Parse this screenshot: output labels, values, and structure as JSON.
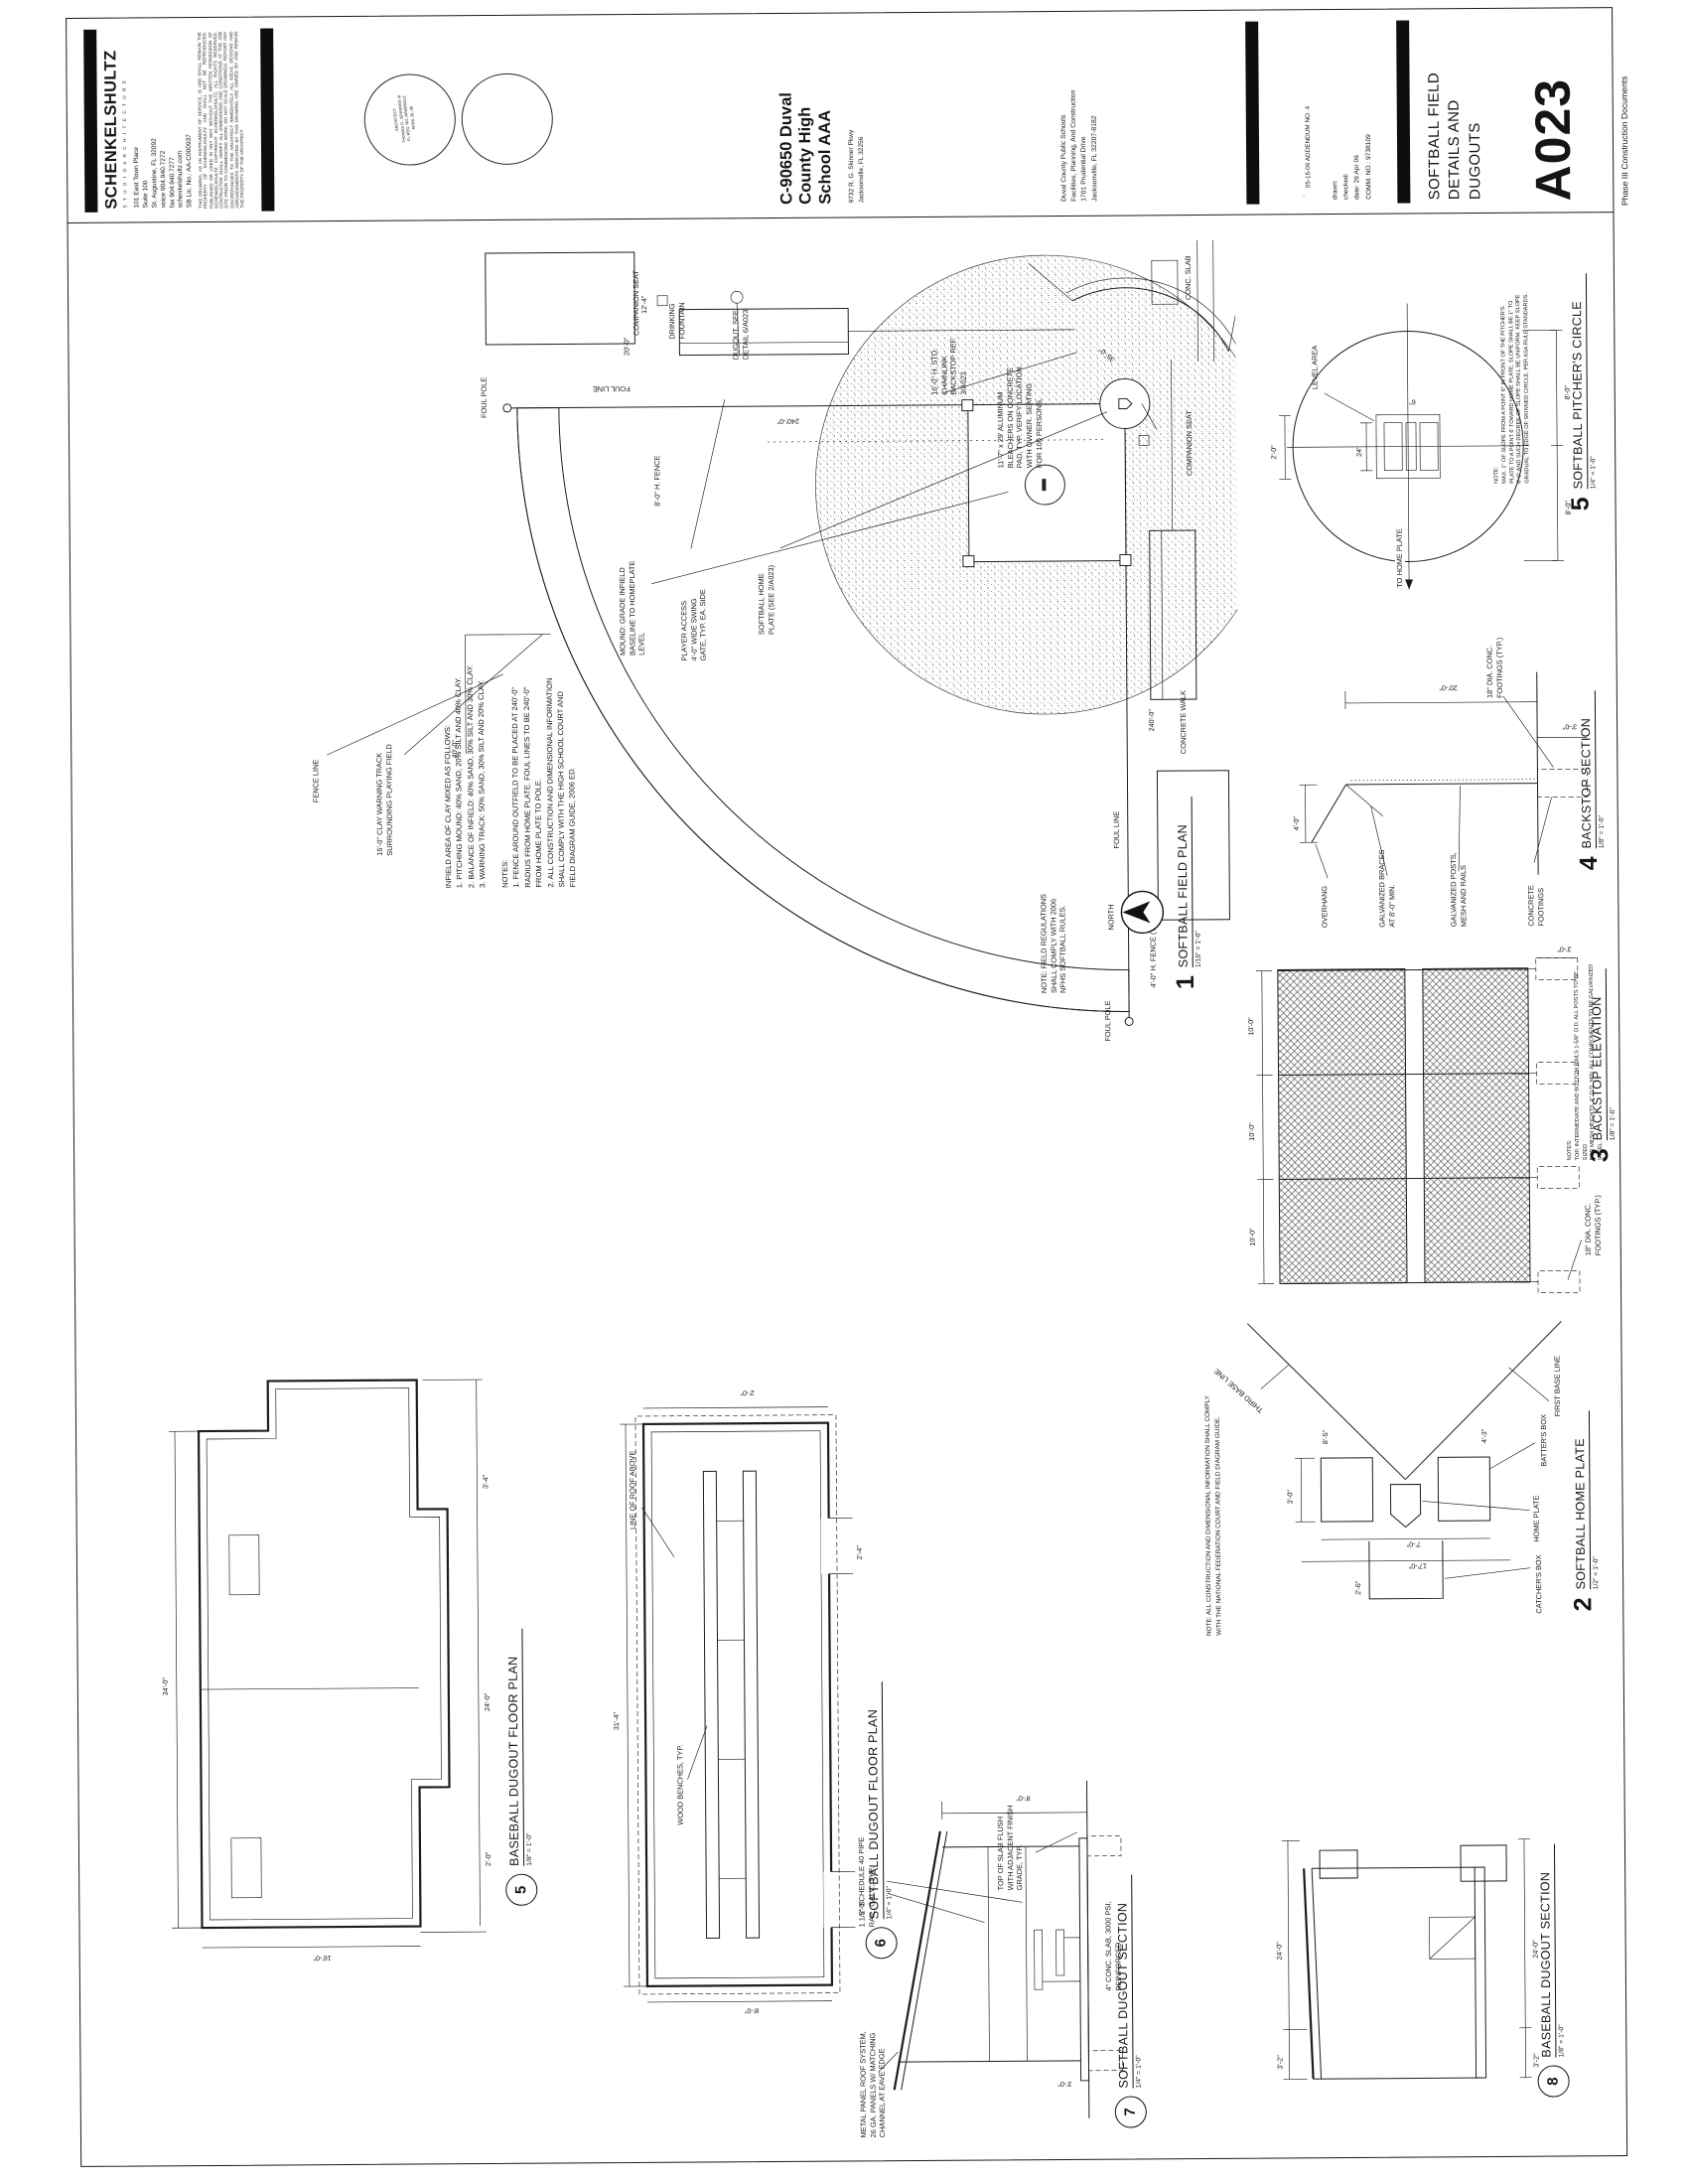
{
  "firm": {
    "name": "SCHENKELSHULTZ",
    "tagline": "S T U D I O   A R C H I T E C T U R E",
    "lines": "101 East Town Place\nSuite 100\nSt. Augustine, FL 32092\nvoice  904.940.7272\nfax  904.940.7277\nschenkelshultz.com\nSB Lic. No.: AA-C000937",
    "disclaimer": "THIS DRAWING, AS AN INSTRUMENT OF SERVICE, IS AND SHALL REMAIN THE PROPERTY OF SCHENKELSHULTZ AND SHALL NOT BE REPRODUCED, PUBLISHED OR USED IN ANY WAY WITHOUT THE WRITTEN PERMISSION OF SCHENKELSHULTZ. COPYRIGHT SCHENKELSHULTZ. ALL RIGHTS RESERVED. CONTRACTOR SHALL VERIFY ALL DIMENSIONS AND CONDITIONS AT THE JOB SITE PRIOR TO COMMENCING WORK. DO NOT SCALE DRAWINGS. REPORT ANY DISCREPANCIES TO THE ARCHITECT IMMEDIATELY. ALL IDEAS, DESIGNS AND ARRANGEMENTS INDICATED BY THIS DRAWING ARE OWNED BY AND REMAIN THE PROPERTY OF THE ARCHITECT."
  },
  "seal": {
    "text": "ARCHITECT\nTHOMAS G. JENNINGS III\nFL REG. NO. AR0009413\nAPRIL 26, 06"
  },
  "project": {
    "name": "C-90650 Duval\nCounty High\nSchool AAA",
    "addr": "9732 R. G. Skinner Pkwy\nJacksonville, FL 32256"
  },
  "owner": {
    "lines": "Duval County Public Schools\nFacilities, Planning, And Construction\n1701 Prudential Drive\nJacksonville, FL 32207-8182"
  },
  "revision": {
    "entry": "05-15-06   ADDENDUM NO. 4"
  },
  "credits": {
    "lines": "drawn:\nchecked:\ndate:   26 Apr 06\nCOMM. NO.:   9738109"
  },
  "sheet": {
    "title": "SOFTBALL FIELD\nDETAILS AND\nDUGOUTS",
    "number": "A023",
    "phase": "Phase III Construction Documents"
  },
  "plan": {
    "num": "1",
    "title": "SOFTBALL FIELD PLAN",
    "scale": "1/16\" = 1'-0\"",
    "north_label": "NORTH",
    "labels": {
      "foul_pole_top": "FOUL POLE",
      "foul_pole_left": "FOUL POLE",
      "fence_line": "FENCE LINE",
      "foul_line_v": "FOUL LINE",
      "foul_line_h": "FOUL LINE",
      "warning_track": "15'-0\" CLAY WARNING TRACK\nSURROUNDING PLAYING FIELD",
      "home_plate": "SOFTBALL HOME\nPLATE (SEE 2/A023)",
      "mound": "MOUND: GRADE INFIELD\nBASELINE TO HOMEPLATE\nLEVEL",
      "backstop": "16'-0\" H. STD.\nCHAINLINK\nBACKSTOP REF.\n3/A023",
      "bleachers": "11'-7\" x 29' ALUMINUM\nBLEACHERS ON CONCRETE\nPAD, TYP. VERIFY LOCATION\nWITH OWNER. SEATING\nFOR 100 PERSONS.",
      "dugout": "DUGOUT, SEE\nDETAIL 6/A023",
      "fountain": "DRINKING\nFOUNTAIN",
      "companion1": "COMPANION SEAT",
      "companion2": "COMPANION SEAT",
      "gate": "PLAYER ACCESS\n4'-0\" WIDE SWING\nGATE, TYP. EA. SIDE",
      "fence4": "4'-0\" H. FENCE (TYP.)",
      "fence8": "8'-0\" H. FENCE",
      "slab": "CONC. SLAB",
      "walk": "CONCRETE WALK",
      "note": "NOTE: FIELD REGULATIONS\nSHALL COMPLY WITH 2006\nNFHS SOFTBALL RULES."
    },
    "dims": {
      "r1": "240'-0\"",
      "r2": "240'-0\"",
      "d40": "40'-0\"",
      "d35": "35'-0\"",
      "d20": "20'-0\"",
      "d12": "12'-4\""
    },
    "notes_block": "INFIELD AREA OF CLAY MIXED AS FOLLOWS:\n1. PITCHING MOUND: 40% SAND, 20% SILT AND 40% CLAY.\n2. BALANCE OF INFIELD: 40% SAND, 30% SILT AND 30% CLAY.\n3. WARNING TRACK: 50% SAND, 30% SILT AND 20% CLAY.\n \nNOTES:\n1. FENCE AROUND OUTFIELD TO BE PLACED AT 240'-0\"\n    RADIUS FROM HOME PLATE. FOUL LINES TO BE 240'-0\"\n    FROM HOME PLATE TO POLE.\n2. ALL CONSTRUCTION AND DIMENSIONAL INFORMATION\n    SHALL COMPLY WITH THE HIGH SCHOOL COURT AND\n    FIELD DIAGRAM GUIDE, 2006 ED."
  },
  "hp": {
    "num": "2",
    "title": "SOFTBALL HOME PLATE",
    "scale": "1/2\" = 1'-0\"",
    "note": "NOTE:  ALL CONSTRUCTION AND DIMENSIONAL INFORMATION SHALL COMPLY\nWITH THE NATIONAL FEDERATION COURT AND FIELD DIAGRAM GUIDE.",
    "labels": {
      "third": "THIRD BASE LINE",
      "first": "FIRST BASE LINE",
      "home": "HOME PLATE",
      "batter": "BATTER'S BOX",
      "catcher": "CATCHER'S BOX"
    },
    "dims": {
      "d1": "3'-0\"",
      "d2": "7'-0\"",
      "d3": "17'-0\"",
      "d4": "8'-5\"",
      "d5": "2'-6\"",
      "d6": "4'-3\""
    }
  },
  "el": {
    "num": "3",
    "title": "BACKSTOP ELEVATION",
    "scale": "1/8\" = 1'-0\"",
    "notes": "NOTES:\nTOP, INTERMEDIATE AND BOTTOM RAILS 1-5/8\" O.D. ALL POSTS TO BE SIZED\nFOR MESH HEIGHTS, 4\" O.D. MIN. ALL COMPONENTS TO BE GALVANIZED STEEL.",
    "footing_label": "18\" DIA. CONC.\nFOOTINGS (TYP.)",
    "dims": {
      "a": "10'-0\"",
      "b": "10'-0\"",
      "c": "10'-0\"",
      "depth": "3'-0\""
    }
  },
  "sec": {
    "num": "4",
    "title": "BACKSTOP SECTION",
    "scale": "1/8\" = 1'-0\"",
    "labels": {
      "overhang": "OVERHANG",
      "braces": "GALVANIZED BRACES\nAT 8'-0\" MIN.",
      "posts": "GALVANIZED POSTS,\nMESH AND RAILS",
      "footings": "CONCRETE FOOTINGS",
      "dia": "18\" DIA. CONC.\nFOOTINGS (TYP.)"
    },
    "dims": {
      "h": "20'-0\"",
      "oh": "4'-0\"",
      "ft": "3'-0\""
    }
  },
  "pc": {
    "num": "5",
    "title": "SOFTBALL PITCHER'S CIRCLE",
    "scale": "1/4\" = 1'-0\"",
    "note": "NOTE:\nMAX. 1\" OF SLOPE FROM A POINT 6\" IN FRONT OF THE PITCHER'S\nPLATE TO A POINT 6' TOWARD HOME PLATE. SLOPE SHALL BE 1\" TO\n6'-0\" AND SUCH DEGREE OF SLOPE SHALL BE UNIFORM. KEEP SLOPE\nGRADUAL TO EDGE OF SKINNED CIRCLE. PER ASA RULE STANDARDS.",
    "labels": {
      "tohome": "TO HOME PLATE",
      "level": "LEVEL AREA"
    },
    "dims": {
      "half1": "8'-0\"",
      "half2": "8'-0\"",
      "top": "2'-0\"",
      "w24": "24\"",
      "w6": "6\""
    }
  },
  "sp": {
    "num": "6",
    "title": "SOFTBALL DUGOUT FLOOR PLAN",
    "scale": "1/4\" = 1'-0\"",
    "labels": {
      "bench": "WOOD BENCHES, TYP.",
      "roof": "LINE OF ROOF ABOVE"
    },
    "dims": {
      "len": "31'-4\"",
      "dep": "8'-0\"",
      "d1": "5'-0\"",
      "d2": "2'-4\"",
      "d3": "2'-0\""
    }
  },
  "bp": {
    "num": "5",
    "title": "BASEBALL DUGOUT FLOOR PLAN",
    "scale": "1/8\" = 1'-0\"",
    "dims": {
      "len": "34'-0\"",
      "dep": "16'-0\"",
      "b1": "24'-0\"",
      "b2": "3'-4\"",
      "b3": "2'-0\""
    }
  },
  "ss": {
    "num": "7",
    "title": "SOFTBALL DUGOUT SECTION",
    "scale": "1/4\" = 1'-0\"",
    "labels": {
      "roof": "METAL PANEL ROOF SYSTEM,\n26 GA. PANELS W/ MATCHING\nCHANNEL AT EAVE EDGE",
      "rail": "1 1/2\" SCHEDULE 40 PIPE\nRAIL, GALV., TYP.",
      "slabflush": "TOP OF SLAB FLUSH\nWITH ADJACENT FINISH\nGRADE, TYP.",
      "slab": "4\" CONC. SLAB, 3000 PSI,\nREINFORCED"
    },
    "dims": {
      "h": "8'-0\"",
      "b": "3'-0\""
    }
  },
  "bs": {
    "num": "8",
    "title": "BASEBALL DUGOUT SECTION",
    "scale": "1/8\" = 1'-0\"",
    "dims": {
      "t1": "3'-2\"",
      "t2": "24'-0\"",
      "b1": "3'-2\"",
      "b2": "24'-0\""
    }
  }
}
